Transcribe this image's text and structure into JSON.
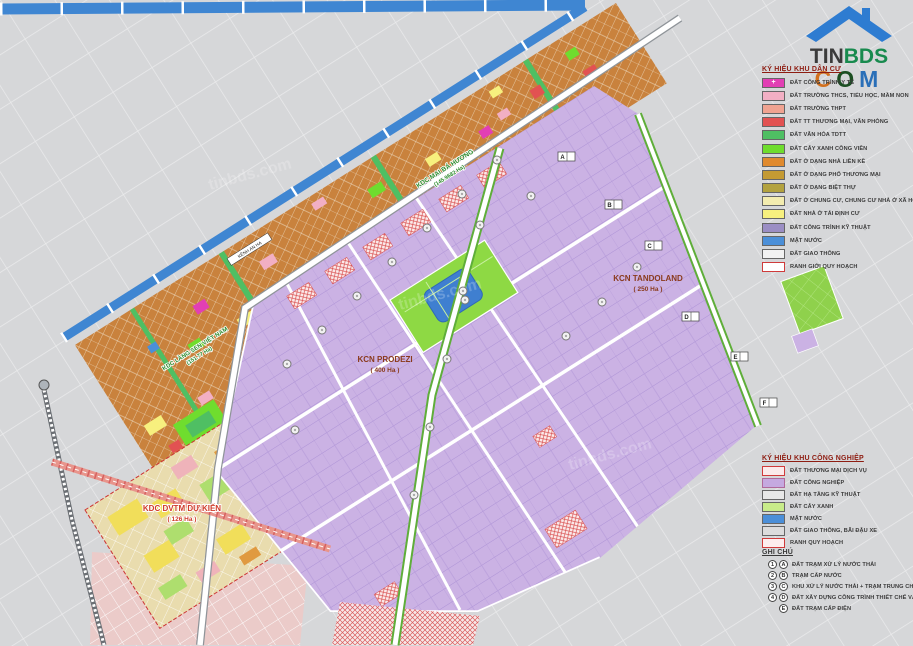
{
  "brand": {
    "name_top_1": "TIN",
    "name_top_2": "BDS",
    "bottom_letters": [
      "C",
      "O",
      "M"
    ],
    "bottom_colors": [
      "#d2701e",
      "#1c4f22",
      "#2a6fb8"
    ],
    "top_colors": [
      "#3b3b3b",
      "#188a4e"
    ],
    "house_roof_color": "#2e7cd1"
  },
  "legend_residential": {
    "title": "KÝ HIỆU KHU DÂN CƯ",
    "items": [
      {
        "label": "ĐẤT CÔNG TRÌNH Y TẾ",
        "color": "#e23fb4",
        "pattern": "plus"
      },
      {
        "label": "ĐẤT TRƯỜNG THCS, TIỂU HỌC, MẦM NON",
        "color": "#f2afc4",
        "pattern": "dots"
      },
      {
        "label": "ĐẤT TRƯỜNG THPT",
        "color": "#f0a391",
        "pattern": "hstripes"
      },
      {
        "label": "ĐẤT TT THƯƠNG MẠI, VĂN PHÒNG",
        "color": "#e25252",
        "pattern": "solid"
      },
      {
        "label": "ĐẤT VĂN HÓA TDTT",
        "color": "#4fbf63",
        "pattern": "dots"
      },
      {
        "label": "ĐẤT CÂY XANH CÔNG VIÊN",
        "color": "#6fdd2e",
        "pattern": "solid"
      },
      {
        "label": "ĐẤT Ở DẠNG NHÀ LIỀN KỀ",
        "color": "#e08a2e",
        "pattern": "solid"
      },
      {
        "label": "ĐẤT Ở DẠNG PHỐ THƯƠNG MẠI",
        "color": "#c49a33",
        "pattern": "solid"
      },
      {
        "label": "ĐẤT Ở DẠNG BIỆT THỰ",
        "color": "#b3a23f",
        "pattern": "solid"
      },
      {
        "label": "ĐẤT Ở CHUNG CƯ, CHUNG CƯ NHÀ Ở XÃ HỘI",
        "color": "#f3ecaf",
        "pattern": "solid"
      },
      {
        "label": "ĐẤT NHÀ Ở TÁI ĐỊNH CƯ",
        "color": "#f7f07e",
        "pattern": "solid"
      },
      {
        "label": "ĐẤT CÔNG TRÌNH KỸ THUẬT",
        "color": "#9b8ec4",
        "pattern": "vstripes"
      },
      {
        "label": "MẶT NƯỚC",
        "color": "#4b8fd8",
        "pattern": "solid"
      },
      {
        "label": "ĐẤT GIAO THÔNG",
        "color": "#f2f2f2",
        "pattern": "hstripes-gray"
      },
      {
        "label": "RANH GIỚI QUY HOẠCH",
        "color": "#ffffff",
        "pattern": "red-border"
      }
    ]
  },
  "legend_industrial": {
    "title": "KÝ HIỆU KHU CÔNG NGHIỆP",
    "items": [
      {
        "label": "ĐẤT THƯƠNG MẠI DỊCH VỤ",
        "color": "#fbeaea",
        "pattern": "crosshatch-red",
        "border": "#cf3b3b"
      },
      {
        "label": "ĐẤT CÔNG NGHIỆP",
        "color": "#c5a9e0",
        "pattern": "solid",
        "border": "#b06a9a"
      },
      {
        "label": "ĐẤT HẠ TẦNG KỸ THUẬT",
        "color": "#e8e8e8",
        "pattern": "hstripes-gray"
      },
      {
        "label": "ĐẤT CÂY XANH",
        "color": "#c8ec8a",
        "pattern": "solid"
      },
      {
        "label": "MẶT NƯỚC",
        "color": "#4b8fd8",
        "pattern": "solid"
      },
      {
        "label": "ĐẤT GIAO THÔNG, BÃI ĐẬU XE",
        "color": "#dcdcdc",
        "pattern": "hstripes-gray"
      },
      {
        "label": "RANH QUY HOẠCH",
        "color": "#fdeeee",
        "pattern": "red-border"
      }
    ]
  },
  "notes": {
    "title": "GHI CHÚ",
    "items": [
      {
        "symbols": [
          "1",
          "A"
        ],
        "label": "ĐẤT TRẠM XỬ LÝ NƯỚC THẢI"
      },
      {
        "symbols": [
          "2",
          "B"
        ],
        "label": "TRẠM CẤP NƯỚC"
      },
      {
        "symbols": [
          "3",
          "C"
        ],
        "label": "KHU XỬ LÝ NƯỚC THẢI + TRẠM TRUNG CHUYỂN RÁC"
      },
      {
        "symbols": [
          "4",
          "D"
        ],
        "label": "ĐẤT XÂY DỰNG CÔNG TRÌNH THIẾT CHẾ VĂN HÓA"
      },
      {
        "symbols": [
          "E"
        ],
        "label": "ĐẤT TRẠM CẤP ĐIỆN"
      }
    ]
  },
  "map": {
    "labels": {
      "kcn_prodezi_name": "KCN PRODEZI",
      "kcn_prodezi_area": "( 400 Ha )",
      "kcn_tandoland_name": "KCN TANDOLAND",
      "kcn_tandoland_area": "( 250 Ha )",
      "kdc_dvtm_name": "KDC DVTM DỰ KIẾN",
      "kdc_dvtm_area": "( 126 Ha )",
      "kdc_maibahuong_name": "KDC MAI BÁ HƯƠNG",
      "kdc_maibahuong_area": "(145.9682 Ha)",
      "kdc_langsen_name": "KDC LÀNG SEN VIỆT NAM",
      "kdc_langsen_area": "(151.77 Ha)",
      "canal_name": "KÊNH AN HẠ",
      "watermark": "tinbds.com"
    },
    "lot_markers": [
      "A",
      "B",
      "C",
      "D",
      "E",
      "F"
    ]
  },
  "colors": {
    "background": "#d6d7d9",
    "canal_blue": "#3f86d2",
    "industrial_purple": "#cbb2e4",
    "residential_orange": "#c9823d",
    "park_green": "#8ed944",
    "lake_blue": "#3f7fd0",
    "commercial_hatch_red": "#d94f4f",
    "boundary_red": "#cc3333"
  }
}
